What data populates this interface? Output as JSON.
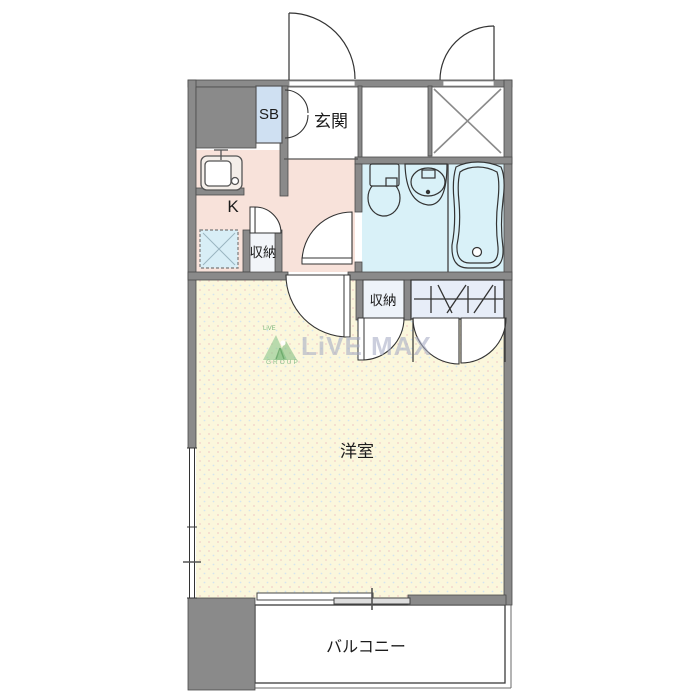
{
  "floor_plan": {
    "rooms": {
      "shoe_box": {
        "label": "SB"
      },
      "entrance": {
        "label": "玄関"
      },
      "kitchen": {
        "label": "K"
      },
      "hall_storage": {
        "label": "収納"
      },
      "room_storage": {
        "label": "収納"
      },
      "western_room": {
        "label": "洋室"
      },
      "balcony": {
        "label": "バルコニー"
      }
    },
    "watermark": {
      "brand": "LiVE MAX",
      "logo_small_text": "LiVE",
      "group_text": "GROUP"
    },
    "colors": {
      "wall": "#8A8A8A",
      "kitchen_hall_floor": "#F8E2DA",
      "bathroom_floor": "#D9F1F8",
      "western_room_floor": "#FBF7DC",
      "shoe_box_fill": "#CFE0F2",
      "closet_fill": "#E7EDF8",
      "washer_pan_fill": "#D8EEF6",
      "balcony_floor": "#FFFFFF",
      "watermark_text": "#A5AAC4",
      "watermark_logo_green": "#8CC68C",
      "line": "#3C3C3C"
    }
  }
}
